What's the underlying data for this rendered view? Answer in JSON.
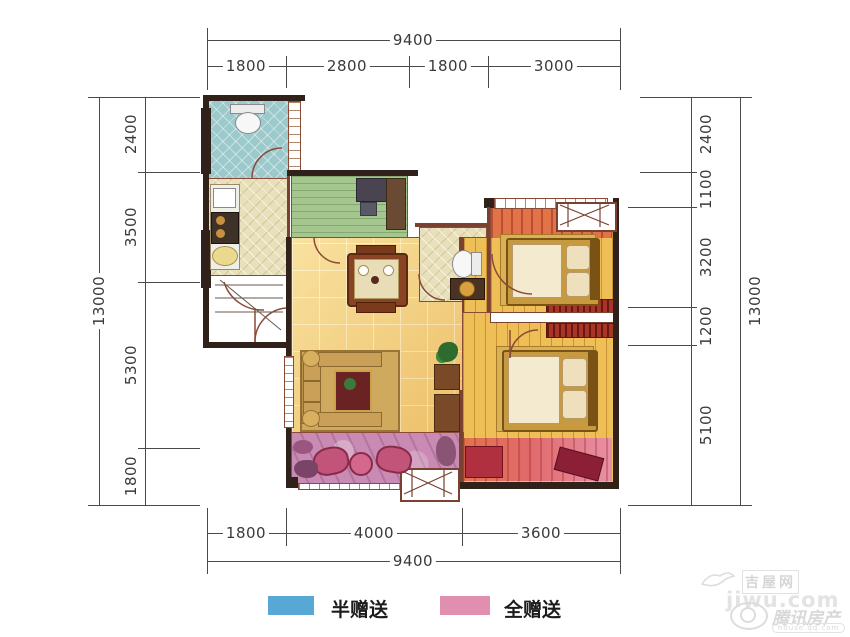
{
  "dimensions": {
    "top": {
      "total": "9400",
      "segments": [
        "1800",
        "2800",
        "1800",
        "3000"
      ]
    },
    "bottom": {
      "total": "9400",
      "segments": [
        "1800",
        "4000",
        "3600"
      ]
    },
    "left": {
      "total": "13000",
      "segments": [
        "2400",
        "3500",
        "5300",
        "1800"
      ]
    },
    "right": {
      "total": "13000",
      "segments": [
        "2400",
        "1100",
        "3200",
        "1200",
        "5100"
      ]
    }
  },
  "legend": {
    "items": [
      {
        "label": "半赠送",
        "color": "#58a8d5"
      },
      {
        "label": "全赠送",
        "color": "#e08fae"
      }
    ]
  },
  "watermarks": {
    "jiwu": {
      "site": "吉屋网",
      "url": "jiwu.com"
    },
    "tencent": {
      "brand": "腾讯房产",
      "url": "house.qq.com"
    }
  },
  "palette": {
    "wall": "#30221a",
    "wall_trim": "#7a4030",
    "tile_floor_yellow": "#f2d07b",
    "wood_floor": "#eebf57",
    "bath_tile_teal": "#9cc9cb",
    "kitchen_tile_cream": "#e8e0ba",
    "study_floor_green": "#a5c68e",
    "bay_stripe_orange": "#e27247",
    "gift_strip_pink": "#e890a6",
    "balcony_pink": "#c98bb4",
    "wardrobe_red": "#a93527"
  }
}
